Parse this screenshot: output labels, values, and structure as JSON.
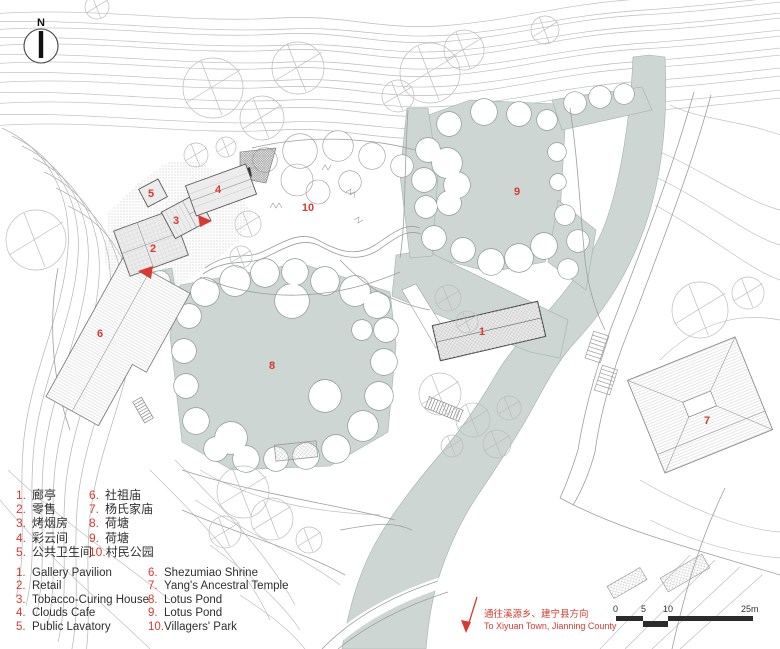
{
  "north": {
    "label": "N"
  },
  "markers": [
    "1",
    "2",
    "3",
    "4",
    "5",
    "6",
    "7",
    "8",
    "9",
    "10"
  ],
  "legend": {
    "zh": [
      {
        "num": "1.",
        "label": "廊亭"
      },
      {
        "num": "2.",
        "label": "零售"
      },
      {
        "num": "3.",
        "label": "烤烟房"
      },
      {
        "num": "4.",
        "label": "彩云间"
      },
      {
        "num": "5.",
        "label": "公共卫生间"
      },
      {
        "num": "6.",
        "label": "社祖庙"
      },
      {
        "num": "7.",
        "label": "杨氏家庙"
      },
      {
        "num": "8.",
        "label": "荷塘"
      },
      {
        "num": "9.",
        "label": "荷塘"
      },
      {
        "num": "10.",
        "label": "村民公园"
      }
    ],
    "en": [
      {
        "num": "1.",
        "label": "Gallery Pavilion"
      },
      {
        "num": "2.",
        "label": "Retail"
      },
      {
        "num": "3.",
        "label": "Tobacco-Curing House"
      },
      {
        "num": "4.",
        "label": "Clouds Cafe"
      },
      {
        "num": "5.",
        "label": "Public Lavatory"
      },
      {
        "num": "6.",
        "label": "Shezumiao Shrine"
      },
      {
        "num": "7.",
        "label": "Yang's Ancestral Temple"
      },
      {
        "num": "8.",
        "label": "Lotus Pond"
      },
      {
        "num": "9.",
        "label": "Lotus Pond"
      },
      {
        "num": "10.",
        "label": "Villagers' Park"
      }
    ]
  },
  "direction_note": {
    "zh": "通往溪源乡、建宁县方向",
    "en": "To Xiyuan Town, Jianning County"
  },
  "scale_bar": {
    "ticks": [
      "0",
      "5",
      "10",
      "25m"
    ]
  },
  "colors": {
    "water": "#cdd6d3",
    "marker_red": "#d9392e",
    "contour": "#bcbcbc",
    "bar_dark": "#2b2b2b"
  }
}
